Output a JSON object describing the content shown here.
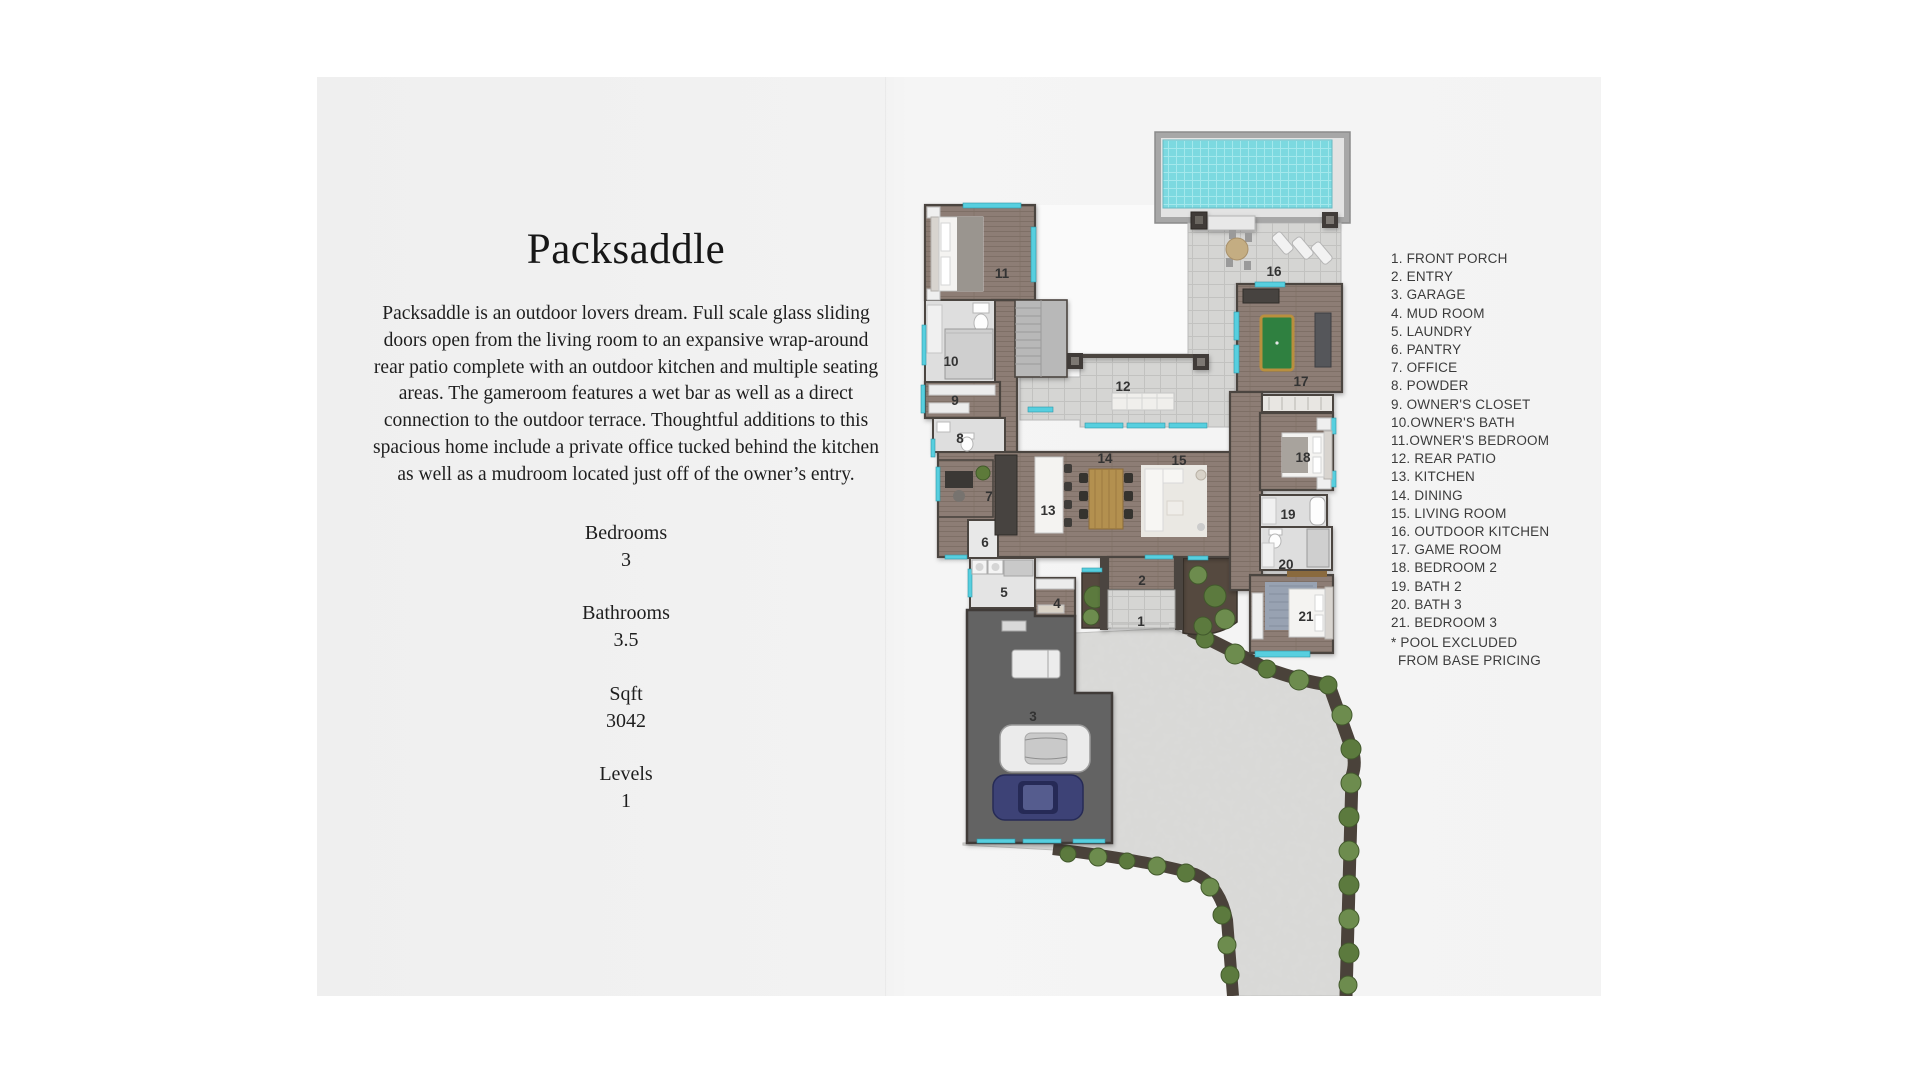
{
  "intro": {
    "title": "Packsaddle",
    "description": "Packsaddle is an outdoor lovers dream. Full scale glass sliding doors open from the living room to an expansive wrap-around rear patio complete with an outdoor kitchen and multiple seating areas. The gameroom features a wet bar as well as a direct connection to the outdoor terrace. Thoughtful additions to this spacious home include a private office tucked behind the kitchen as well as a mudroom located just off of the owner’s entry."
  },
  "stats": {
    "items": [
      {
        "label": "Bedrooms",
        "value": "3"
      },
      {
        "label": "Bathrooms",
        "value": "3.5"
      },
      {
        "label": "Sqft",
        "value": "3042"
      },
      {
        "label": "Levels",
        "value": "1"
      }
    ]
  },
  "legend": {
    "items": [
      "1. FRONT PORCH",
      "2. ENTRY",
      "3. GARAGE",
      "4. MUD ROOM",
      "5. LAUNDRY",
      "6. PANTRY",
      "7. OFFICE",
      "8. POWDER",
      "9. OWNER'S CLOSET",
      "10.OWNER'S BATH",
      "11.OWNER'S BEDROOM",
      "12. REAR PATIO",
      "13. KITCHEN",
      "14. DINING",
      "15. LIVING ROOM",
      "16. OUTDOOR KITCHEN",
      "17. GAME ROOM",
      "18. BEDROOM 2",
      "19. BATH 2",
      "20. BATH 3",
      "21. BEDROOM 3"
    ],
    "note1": "* POOL EXCLUDED",
    "note2": "FROM BASE PRICING"
  },
  "plan": {
    "labels": [
      "1",
      "2",
      "3",
      "4",
      "5",
      "6",
      "7",
      "8",
      "9",
      "10",
      "11",
      "12",
      "13",
      "14",
      "15",
      "16",
      "17",
      "18",
      "19",
      "20",
      "21"
    ],
    "colors": {
      "pool_water": "#7cd9e0",
      "window": "#57cfdf",
      "wood_floor": "#8d7d74",
      "pavers": "#d5d5d3",
      "driveway": "#d8d8d6",
      "shrub": "#5c7a3e",
      "soil": "#55493f",
      "garage_floor": "#636363"
    }
  }
}
